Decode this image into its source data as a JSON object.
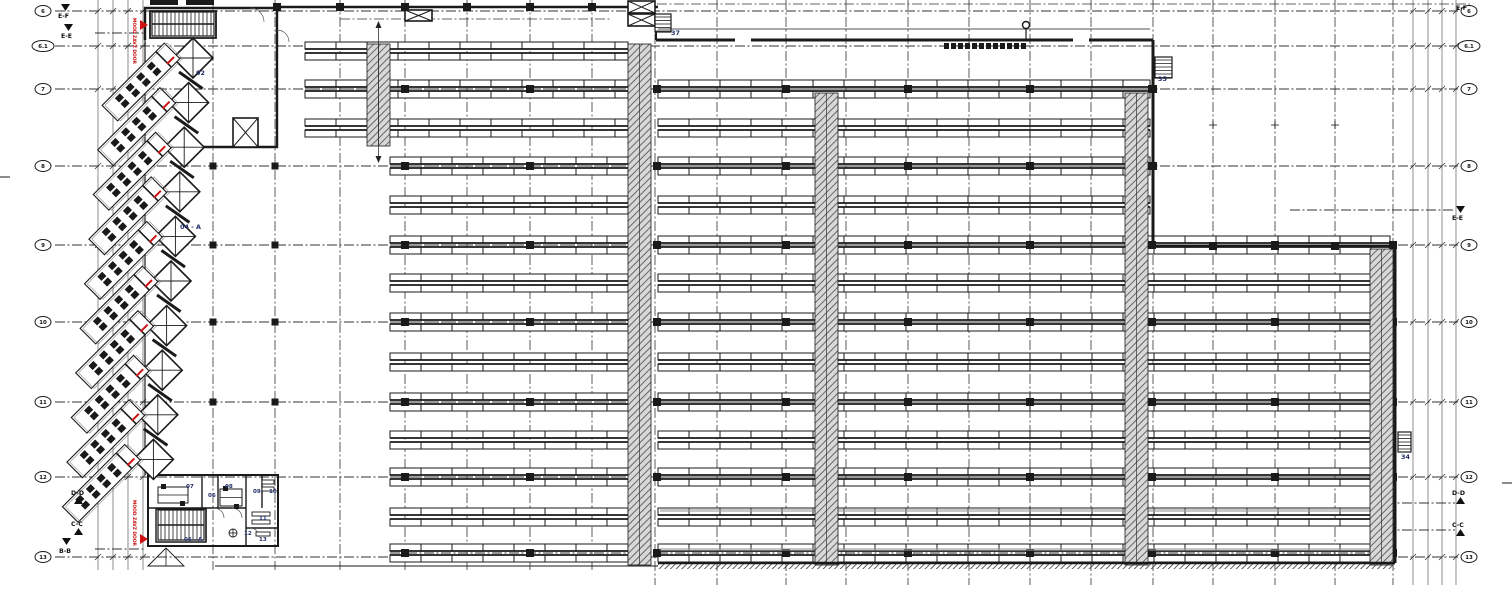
{
  "title": "warehouse-floor-plan",
  "colors": {
    "ink": "#1a1a1a",
    "navy": "#23306b",
    "red": "#cc1212",
    "hatch": "#555",
    "gray": "#999",
    "chain": "#333"
  },
  "grid": {
    "rows": [
      {
        "label": "6",
        "y": 11,
        "wide": false
      },
      {
        "label": "6.1",
        "y": 46,
        "wide": true
      },
      {
        "label": "7",
        "y": 89,
        "wide": false
      },
      {
        "label": "8",
        "y": 166,
        "wide": false
      },
      {
        "label": "9",
        "y": 245,
        "wide": false
      },
      {
        "label": "10",
        "y": 322,
        "wide": false
      },
      {
        "label": "11",
        "y": 402,
        "wide": false
      },
      {
        "label": "12",
        "y": 477,
        "wide": false
      },
      {
        "label": "13",
        "y": 557,
        "wide": false
      }
    ],
    "row_x1": 55,
    "row_x2": 1458,
    "bubble_left_x": 43,
    "bubble_right_x": 1469,
    "cols_left": [
      213,
      275,
      340,
      405,
      467,
      530,
      592
    ],
    "cols_right": [
      655,
      717,
      786,
      846,
      908,
      969,
      1030,
      1091,
      1153,
      1213,
      1275,
      1335,
      1393
    ],
    "dims_left": [
      98,
      113,
      128,
      143
    ],
    "dims_right": [
      1413,
      1428,
      1442,
      1456
    ]
  },
  "racks": {
    "band_h": 7,
    "band_gap": 4,
    "bay_w": 31,
    "col_x": [
      405,
      530,
      657,
      786,
      908,
      1030,
      1152,
      1275,
      1393
    ],
    "rows": [
      {
        "y": 51,
        "cols": false,
        "segs": [
          [
            305,
            628
          ]
        ]
      },
      {
        "y": 89,
        "cols": true,
        "segs": [
          [
            305,
            628
          ],
          [
            658,
            1150
          ]
        ]
      },
      {
        "y": 128,
        "cols": false,
        "segs": [
          [
            305,
            628
          ],
          [
            658,
            1150
          ]
        ]
      },
      {
        "y": 166,
        "cols": true,
        "segs": [
          [
            390,
            628
          ],
          [
            658,
            1150
          ]
        ]
      },
      {
        "y": 205,
        "cols": false,
        "segs": [
          [
            390,
            628
          ],
          [
            658,
            1150
          ]
        ]
      },
      {
        "y": 245,
        "cols": true,
        "segs": [
          [
            390,
            628
          ],
          [
            658,
            1390
          ]
        ]
      },
      {
        "y": 283,
        "cols": false,
        "segs": [
          [
            390,
            628
          ],
          [
            658,
            1390
          ]
        ]
      },
      {
        "y": 322,
        "cols": true,
        "segs": [
          [
            390,
            628
          ],
          [
            658,
            1390
          ]
        ]
      },
      {
        "y": 362,
        "cols": false,
        "segs": [
          [
            390,
            628
          ],
          [
            658,
            1390
          ]
        ]
      },
      {
        "y": 402,
        "cols": true,
        "segs": [
          [
            390,
            628
          ],
          [
            658,
            1390
          ]
        ]
      },
      {
        "y": 440,
        "cols": false,
        "segs": [
          [
            390,
            628
          ],
          [
            658,
            1390
          ]
        ]
      },
      {
        "y": 477,
        "cols": true,
        "segs": [
          [
            390,
            628
          ],
          [
            658,
            1390
          ]
        ]
      },
      {
        "y": 517,
        "cols": false,
        "segs": [
          [
            390,
            628
          ],
          [
            658,
            1390
          ]
        ]
      },
      {
        "y": 553,
        "cols": true,
        "segs": [
          [
            390,
            628
          ],
          [
            658,
            1390
          ]
        ]
      }
    ]
  },
  "hatch_bands": [
    {
      "x": 367,
      "y": 44,
      "w": 23,
      "h": 102,
      "arrow": true
    },
    {
      "x": 628,
      "y": 44,
      "w": 23,
      "h": 521,
      "arrow": false
    },
    {
      "x": 815,
      "y": 93,
      "w": 23,
      "h": 472,
      "arrow": false
    },
    {
      "x": 1125,
      "y": 93,
      "w": 23,
      "h": 472,
      "arrow": false
    },
    {
      "x": 1370,
      "y": 249,
      "w": 23,
      "h": 316,
      "arrow": false
    }
  ],
  "walls": [
    {
      "d": "M145,40 L145,8 L277,8 L277,147 L148,147",
      "w": 2.4
    },
    {
      "d": "M150,11 H216 V38 H150 Z",
      "w": 1.8
    },
    {
      "d": "M277,7 H658",
      "w": 2.6
    },
    {
      "d": "M656,26 V40",
      "w": 2
    },
    {
      "d": "M656,40 H1153",
      "w": 3
    },
    {
      "d": "M1153,40 V246",
      "w": 3
    },
    {
      "d": "M1153,246 H1395",
      "w": 3
    },
    {
      "d": "M1395,246 V563",
      "w": 3
    },
    {
      "d": "M658,563 H1395",
      "w": 2.6
    },
    {
      "d": "M215,566 H658",
      "w": 1
    },
    {
      "d": "M145,40 V475",
      "w": 1.2
    },
    {
      "d": "M148,475 H278 V546 H148 Z",
      "w": 2
    },
    {
      "d": "M202,475 V508",
      "w": 1.4
    },
    {
      "d": "M218,475 V508",
      "w": 1.4
    },
    {
      "d": "M246,475 V546",
      "w": 1.4
    },
    {
      "d": "M262,475 V508",
      "w": 1.4
    },
    {
      "d": "M148,508 H246",
      "w": 1.4
    },
    {
      "d": "M246,528 H278",
      "w": 1.4
    },
    {
      "d": "M206,508 V542",
      "w": 1.4
    },
    {
      "d": "M156,509 H206 V542 H156 Z",
      "w": 1.4
    }
  ],
  "door_gaps": [
    {
      "x": 735,
      "y": 36,
      "w": 16,
      "h": 8
    },
    {
      "x": 1073,
      "y": 36,
      "w": 16,
      "h": 8
    }
  ],
  "crossed_boxes": [
    {
      "x": 405,
      "y": 10,
      "w": 27,
      "h": 11
    },
    {
      "x": 628,
      "y": 1,
      "w": 27,
      "h": 12
    },
    {
      "x": 628,
      "y": 14,
      "w": 27,
      "h": 12
    },
    {
      "x": 233,
      "y": 118,
      "w": 25,
      "h": 29
    }
  ],
  "stairs": [
    {
      "x": 152,
      "y": 12,
      "w": 62,
      "h": 24,
      "dir": "h"
    },
    {
      "x": 655,
      "y": 14,
      "w": 16,
      "h": 18,
      "dir": "v"
    },
    {
      "x": 1155,
      "y": 57,
      "w": 17,
      "h": 21,
      "dir": "v"
    },
    {
      "x": 1398,
      "y": 432,
      "w": 13,
      "h": 20,
      "dir": "v"
    },
    {
      "x": 158,
      "y": 510,
      "w": 46,
      "h": 30,
      "dir": "h"
    }
  ],
  "labels": [
    {
      "text": "02",
      "x": 196,
      "y": 75
    },
    {
      "text": "04 - A",
      "x": 180,
      "y": 229
    },
    {
      "text": "37",
      "x": 671,
      "y": 35
    },
    {
      "text": "35",
      "x": 1158,
      "y": 81
    },
    {
      "text": "34",
      "x": 1401,
      "y": 459
    }
  ],
  "office_rooms": [
    {
      "text": "07",
      "x": 186,
      "y": 488
    },
    {
      "text": "06",
      "x": 208,
      "y": 497
    },
    {
      "text": "08",
      "x": 225,
      "y": 488
    },
    {
      "text": "09",
      "x": 253,
      "y": 493
    },
    {
      "text": "10",
      "x": 269,
      "y": 493
    },
    {
      "text": "11",
      "x": 259,
      "y": 520
    },
    {
      "text": "12",
      "x": 244,
      "y": 535
    },
    {
      "text": "13",
      "x": 259,
      "y": 541
    },
    {
      "text": "06 - A",
      "x": 184,
      "y": 541
    }
  ],
  "sections": [
    {
      "text": "E-F",
      "x": 58,
      "y": 14,
      "tri": "down",
      "tx": 61,
      "ty": 4
    },
    {
      "text": "E-E",
      "x": 61,
      "y": 34,
      "tri": "down",
      "tx": 64,
      "ty": 24
    },
    {
      "text": "D-D",
      "x": 71,
      "y": 491,
      "tri": "up",
      "tx": 74,
      "ty": 497
    },
    {
      "text": "C-C",
      "x": 71,
      "y": 522,
      "tri": "up",
      "tx": 74,
      "ty": 528
    },
    {
      "text": "B-B",
      "x": 59,
      "y": 549,
      "tri": "down",
      "tx": 62,
      "ty": 538
    },
    {
      "text": "E-F",
      "x": 1456,
      "y": 6,
      "tri": "none",
      "tx": 0,
      "ty": 0
    },
    {
      "text": "E-E",
      "x": 1452,
      "y": 216,
      "tri": "down",
      "tx": 1456,
      "ty": 206
    },
    {
      "text": "D-D",
      "x": 1452,
      "y": 491,
      "tri": "up",
      "tx": 1456,
      "ty": 497
    },
    {
      "text": "C-C",
      "x": 1452,
      "y": 523,
      "tri": "up",
      "tx": 1456,
      "ty": 529
    }
  ],
  "section_traces": [
    {
      "x1": 95,
      "y": 33,
      "x2": 145
    },
    {
      "x1": 95,
      "y": 549,
      "x2": 145
    },
    {
      "x1": 1290,
      "y": 210,
      "x2": 1455
    },
    {
      "x1": 1385,
      "y": 503,
      "x2": 1455
    },
    {
      "x1": 1385,
      "y": 530,
      "x2": 1455
    }
  ],
  "red_labels": [
    {
      "text": "MOOD ZAVZ DOOR",
      "x": 133,
      "y": 18
    },
    {
      "text": "MOOD ZAVZ DOOR",
      "x": 133,
      "y": 500
    }
  ],
  "red_arrows": [
    {
      "x": 140,
      "y": 25
    },
    {
      "x": 140,
      "y": 539
    }
  ],
  "docks": {
    "count": 10,
    "cx0": 193,
    "cy0": 58,
    "dx": -4.4,
    "dy": 44.6,
    "diamond_r": 20
  },
  "office_desks": [
    {
      "x": 158,
      "y": 487,
      "w": 30,
      "h": 16
    },
    {
      "x": 220,
      "y": 489,
      "w": 22,
      "h": 17
    }
  ],
  "office_fixtures": [
    {
      "x": 262,
      "y": 480,
      "w": 12,
      "h": 4
    },
    {
      "x": 262,
      "y": 487,
      "w": 12,
      "h": 4
    },
    {
      "x": 252,
      "y": 512,
      "w": 18,
      "h": 4
    },
    {
      "x": 252,
      "y": 520,
      "w": 18,
      "h": 4
    },
    {
      "x": 256,
      "y": 532,
      "w": 14,
      "h": 4
    }
  ],
  "misc": {
    "teeth": {
      "x1": 944,
      "x2": 1022,
      "y": 43,
      "step": 7,
      "w": 5,
      "h": 6
    },
    "lollipop": {
      "cx": 1026,
      "cy": 25,
      "r": 3.5,
      "stem_to": 40
    },
    "canopy_line": {
      "x1": 658,
      "y": 29,
      "x2": 1150
    },
    "dock_canopy_chain": {
      "x1": 340,
      "y": 19,
      "x2": 610
    },
    "top_chain": {
      "x1": 640,
      "y": 4,
      "x2": 1470
    },
    "crosses": [
      [
        1213,
        125
      ],
      [
        1275,
        125
      ],
      [
        1335,
        125
      ]
    ],
    "edge_ticks": [
      {
        "x1": 0,
        "y1": 177,
        "x2": 10,
        "y2": 177
      },
      {
        "x1": 1502,
        "y1": 483,
        "x2": 1512,
        "y2": 483
      }
    ],
    "roof_bars": [
      {
        "x": 150,
        "y": 0,
        "w": 28,
        "h": 5
      },
      {
        "x": 186,
        "y": 0,
        "w": 28,
        "h": 5
      }
    ],
    "gray_lines": [
      {
        "x": 660,
        "y": 509,
        "w": 725,
        "h": 3
      },
      {
        "x": 660,
        "y": 548,
        "w": 725,
        "h": 3
      }
    ],
    "wall_squares": [
      [
        277,
        7
      ],
      [
        340,
        7
      ],
      [
        405,
        7
      ],
      [
        467,
        7
      ],
      [
        530,
        7
      ],
      [
        592,
        7
      ],
      [
        1213,
        246
      ],
      [
        1275,
        246
      ],
      [
        1335,
        246
      ],
      [
        1153,
        89
      ],
      [
        1153,
        166
      ]
    ],
    "open_squares_rows": [
      166,
      245,
      322,
      402
    ],
    "open_squares_cols": [
      213,
      275
    ],
    "wc_circle": {
      "cx": 233,
      "cy": 533,
      "r": 4
    },
    "ramp_triangle": "M148,566 L166,548 L184,566 Z"
  }
}
